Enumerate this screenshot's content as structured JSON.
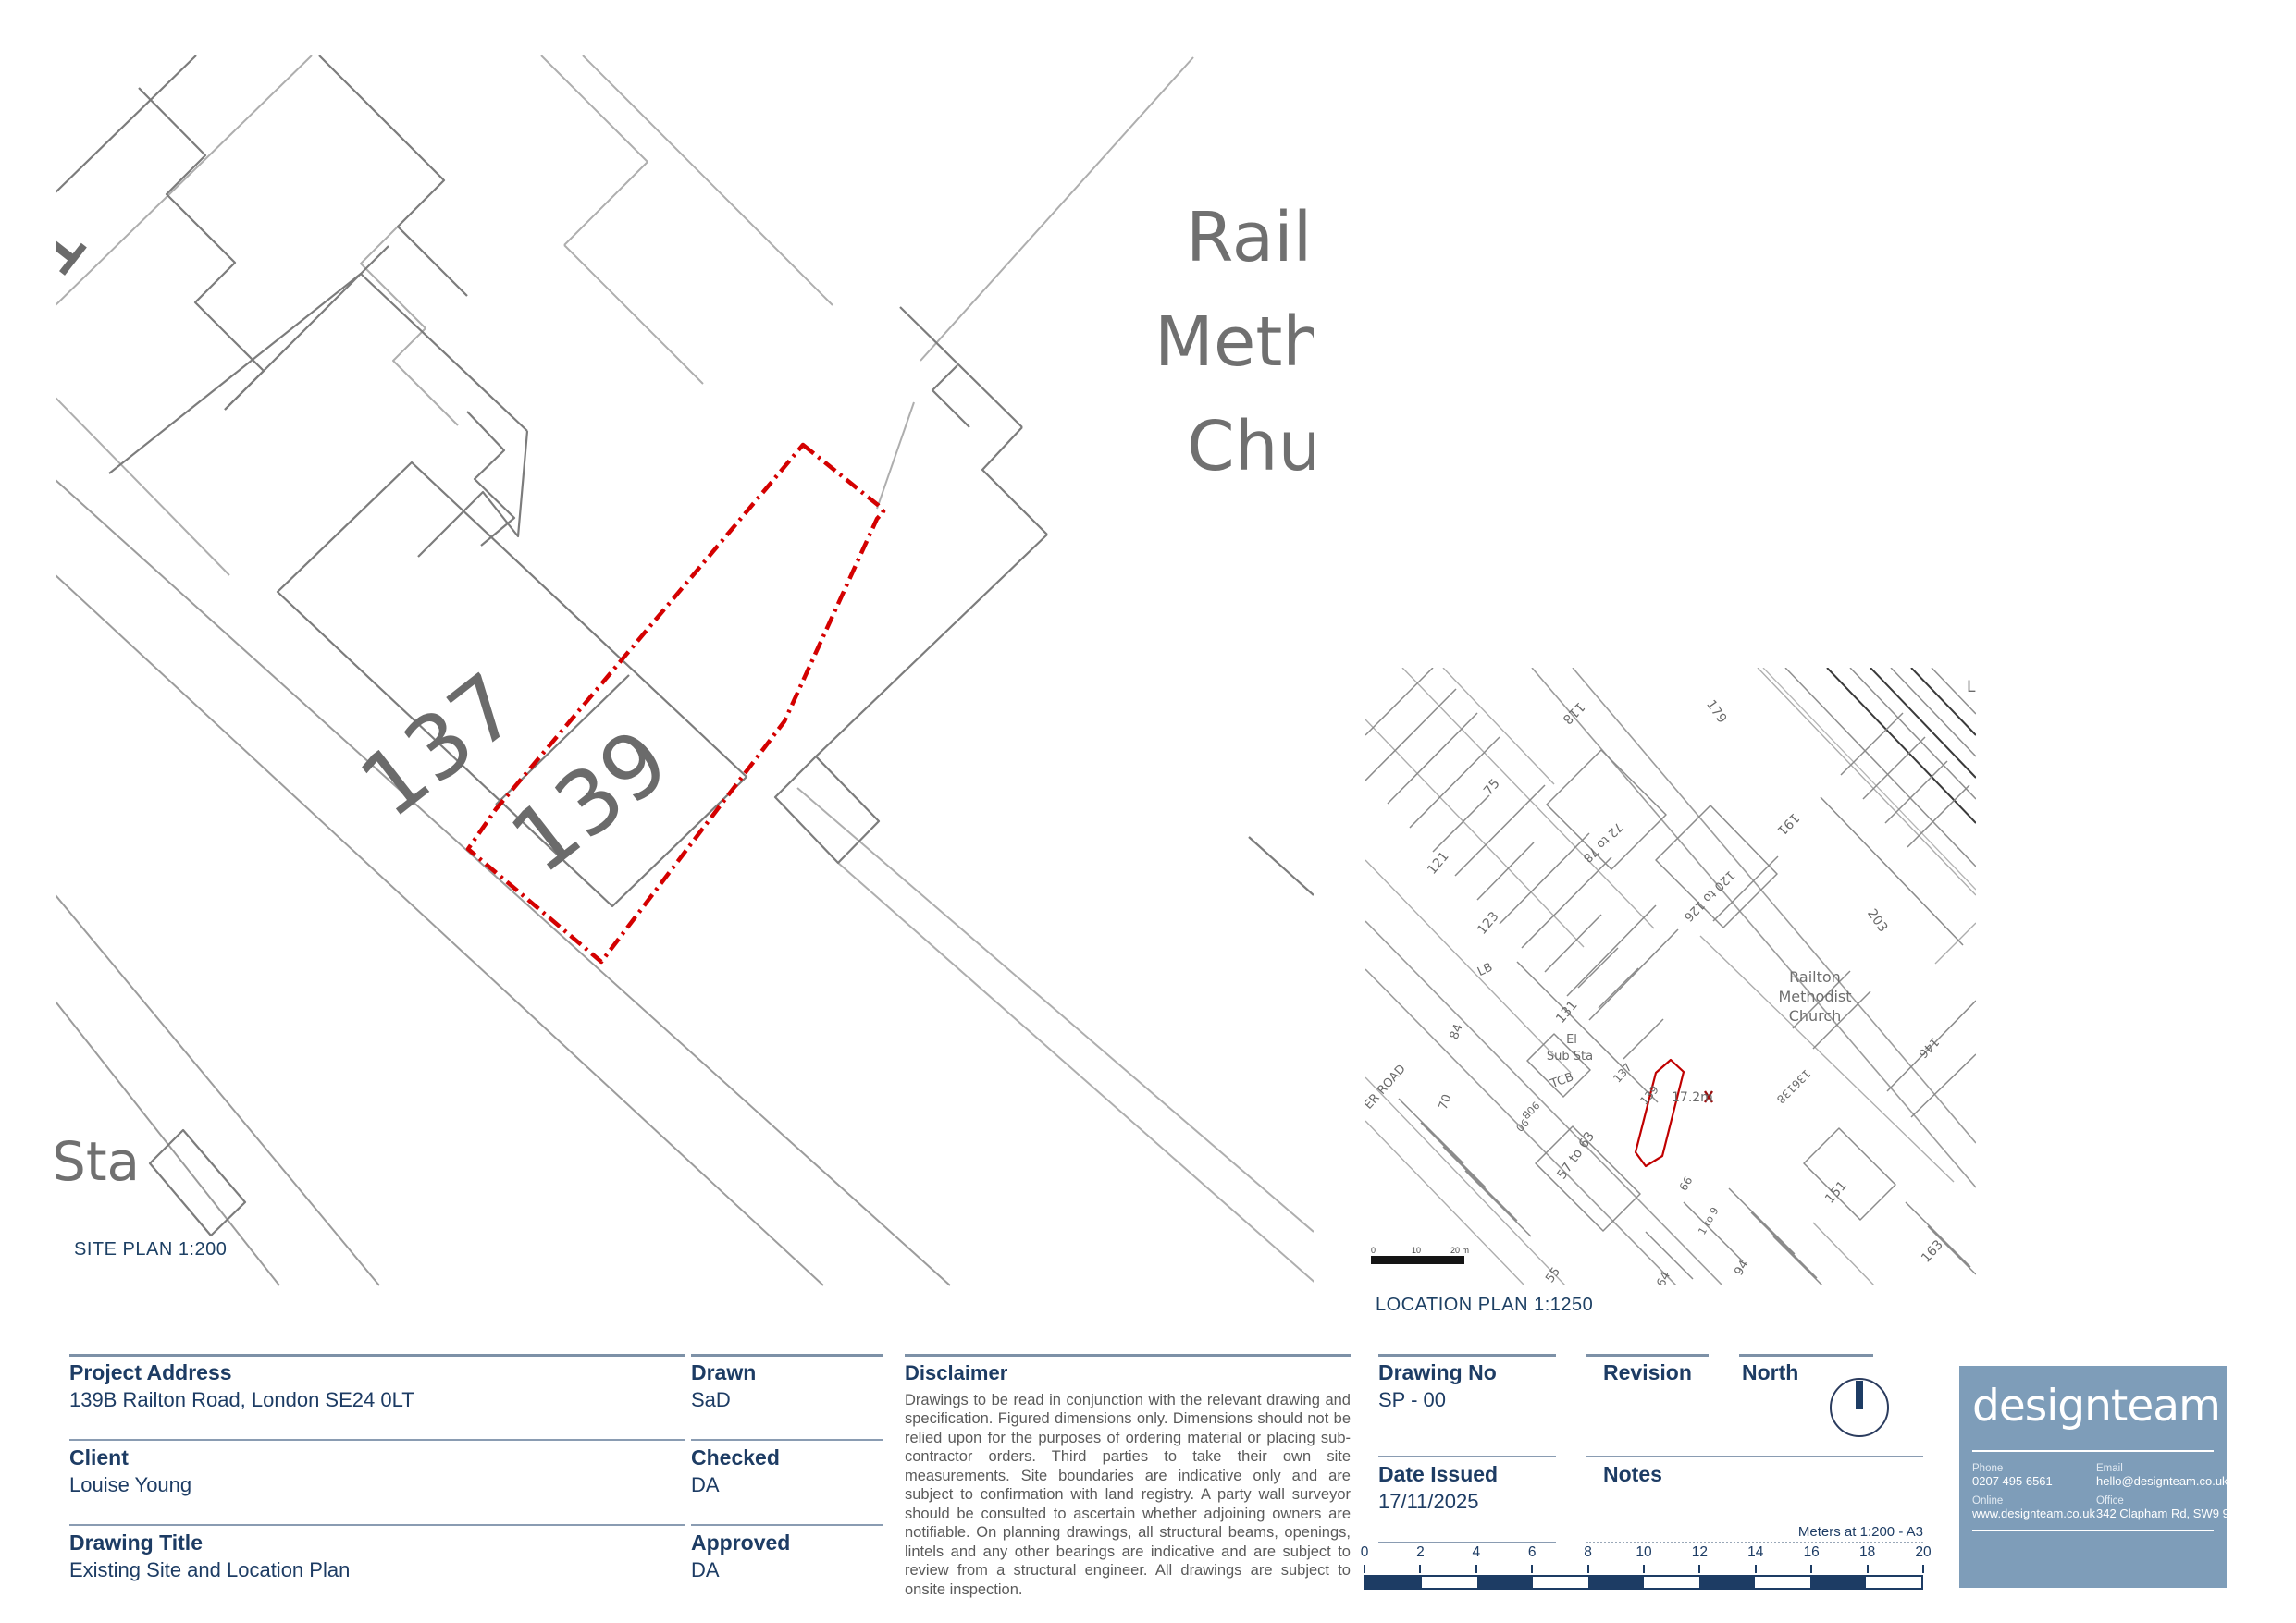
{
  "site_plan": {
    "caption": "SITE PLAN 1:200",
    "labels": {
      "left_partial": "131",
      "house_137": "137",
      "house_139": "139",
      "substation_partial": "Sta",
      "church_line1": "Railton",
      "church_line2": "Methodist",
      "church_line3": "Church"
    }
  },
  "location_plan": {
    "caption": "LOCATION PLAN 1:1250",
    "church_line1": "Railton",
    "church_line2": "Methodist",
    "church_line3": "Church",
    "spot_height": "17.2m",
    "scale_labels": [
      "0",
      "10",
      "20 m"
    ],
    "labels": [
      "118",
      "179",
      "75",
      "121",
      "72 to 78",
      "120 to 126",
      "191",
      "203",
      "123",
      "LB",
      "131",
      "84",
      "ER ROAD",
      "70",
      "TCB",
      "90B",
      "90",
      "137",
      "139",
      "136138",
      "146",
      "El",
      "Sub Sta",
      "57 to 63",
      "55",
      "151",
      "66",
      "1 to 9",
      "94",
      "64",
      "163",
      "L"
    ]
  },
  "title_block": {
    "project_address": {
      "label": "Project Address",
      "value": "139B Railton Road, London SE24 0LT"
    },
    "client": {
      "label": "Client",
      "value": "Louise Young"
    },
    "drawing_title": {
      "label": "Drawing Title",
      "value": "Existing Site and Location Plan"
    },
    "drawn": {
      "label": "Drawn",
      "value": "SaD"
    },
    "checked": {
      "label": "Checked",
      "value": "DA"
    },
    "approved": {
      "label": "Approved",
      "value": "DA"
    },
    "disclaimer": {
      "label": "Disclaimer",
      "text": "Drawings to be read in conjunction with the relevant drawing and specification. Figured dimensions only. Dimensions should not be relied upon for the purposes of ordering material or placing sub-contractor orders. Third parties to take their own site measurements. Site boundaries are indicative only and are subject to confirmation with land registry. A party wall surveyor should be consulted to ascertain whether adjoining owners are notifiable. On planning drawings, all structural beams, openings, lintels and any other bearings are indicative and are subject to review from a structural engineer. All drawings are subject to onsite inspection."
    },
    "drawing_no": {
      "label": "Drawing No",
      "value": "SP - 00"
    },
    "date_issued": {
      "label": "Date Issued",
      "value": "17/11/2025"
    },
    "revision": {
      "label": "Revision",
      "value": ""
    },
    "notes": {
      "label": "Notes",
      "value": ""
    },
    "north": {
      "label": "North"
    },
    "scale_bar": {
      "caption": "Meters at 1:200 - A3",
      "ticks": [
        "0",
        "2",
        "4",
        "6",
        "8",
        "10",
        "12",
        "14",
        "16",
        "18",
        "20"
      ]
    }
  },
  "logo": {
    "brand": "designteam",
    "phone_label": "Phone",
    "phone": "0207 495 6561",
    "email_label": "Email",
    "email": "hello@designteam.co.uk",
    "online_label": "Online",
    "website": "www.designteam.co.uk",
    "office_label": "Office",
    "address": "342 Clapham Rd, SW9 9AJ"
  },
  "colors": {
    "accent_navy": "#1d3c64",
    "rule_gray": "#8a9cb2",
    "logo_blue": "#7e9db9",
    "boundary_red": "#d40000",
    "map_gray": "#8a8a8a",
    "map_label_gray": "#6b6b6b"
  }
}
